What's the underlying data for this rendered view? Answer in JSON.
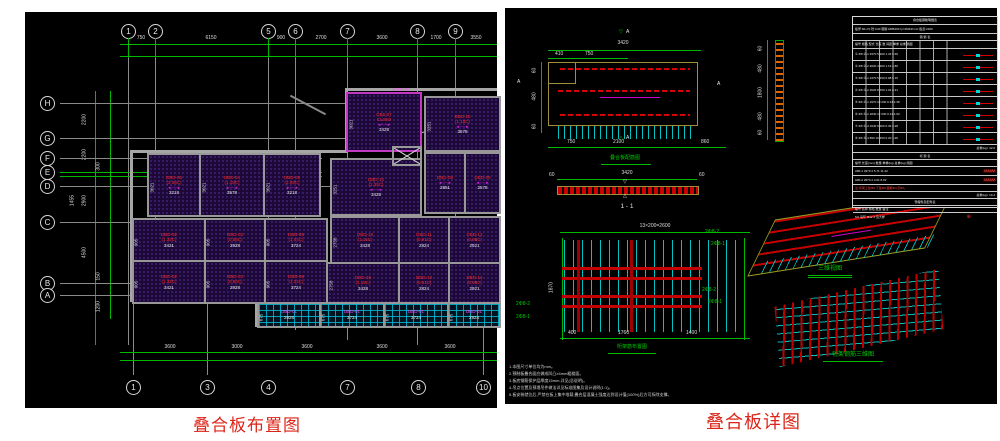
{
  "captions": {
    "left": "叠合板布置图",
    "right": "叠合板详图"
  },
  "glyphs": {
    "arrow": "◄──►",
    "zigzag": "∧∧∧∧∧∧",
    "circle": "⊕",
    "tri_up": "△",
    "tri_down": "▽"
  },
  "left_plan": {
    "top_bubbles": [
      "1",
      "2",
      "5",
      "6",
      "7",
      "8",
      "9"
    ],
    "top_dims": [
      "750",
      "6150",
      "900",
      "2700",
      "3600",
      "1700",
      "3550"
    ],
    "left_bubbles": [
      "H",
      "G",
      "F",
      "E",
      "D",
      "C",
      "B",
      "A"
    ],
    "left_dims": [
      "2200",
      "2200",
      "300",
      "2900",
      "4500",
      "150",
      "1200",
      "1455"
    ],
    "bottom_dims": [
      "3600",
      "3000",
      "3600",
      "3600",
      "3600"
    ],
    "bottom_bubbles": [
      "1",
      "3",
      "4",
      "7",
      "8",
      "10"
    ],
    "tag": "1025130",
    "slabs": [
      {
        "id": "DB6-07",
        "cap": "CL08O",
        "dim": "3428",
        "side": "3021"
      },
      {
        "id": "DBD-15",
        "cap": "(1.18C)",
        "dim": "3578",
        "side": "3251"
      },
      {
        "id": "DBD-06",
        "cap": "(2.08C)",
        "dim": "3218",
        "side": "3021"
      },
      {
        "id": "DBD-04",
        "cap": "(1.18C)",
        "dim": "3578",
        "side": "3021"
      },
      {
        "id": "DBD-06",
        "cap": "(2.08C)",
        "dim": "3218",
        "side": "3021"
      },
      {
        "id": "DBD-10",
        "cap": "(1.35C)",
        "dim": "3428",
        "side": "3251"
      },
      {
        "id": "DBD-08",
        "cap": "(0.95C)",
        "dim": "2851",
        "side": "3051"
      },
      {
        "id": "DBD-09",
        "cap": "(0.91C)",
        "dim": "2578",
        "side": "3051"
      },
      {
        "id": "DBD-18",
        "cap": "(1.15C)",
        "dim": "3428",
        "side": "2758"
      },
      {
        "id": "DBD-02",
        "cap": "(1.32C)",
        "dim": "3421",
        "side": "905"
      },
      {
        "id": "DBD-03",
        "cap": "(0.88C)",
        "dim": "2928",
        "side": "905"
      },
      {
        "id": "DBD-05",
        "cap": "(1.04C)",
        "dim": "3724",
        "side": "905"
      },
      {
        "id": "DBD-11",
        "cap": "(0.91C)",
        "dim": "2824",
        "side": "2851"
      },
      {
        "id": "DBD-12",
        "cap": "(0.95C)",
        "dim": "2921",
        "side": "2851"
      },
      {
        "id": "DBD-02",
        "cap": "(1.32C)",
        "dim": "3421",
        "side": "905"
      },
      {
        "id": "DBD-03",
        "cap": "(0.88C)",
        "dim": "2928",
        "side": "905"
      },
      {
        "id": "DBD-05",
        "cap": "(1.04C)",
        "dim": "3724",
        "side": "905"
      },
      {
        "id": "DBD-16",
        "cap": "(1.15C)",
        "dim": "3428",
        "side": "2758"
      },
      {
        "id": "DBD-13",
        "cap": "(0.91C)",
        "dim": "2824",
        "side": "2851"
      },
      {
        "id": "DBD-14",
        "cap": "(0.95C)",
        "dim": "2921",
        "side": "2851"
      },
      {
        "id": "DBD-01",
        "cap": "(1.08C)",
        "dim": "2928",
        "side": "675"
      },
      {
        "id": "DBD-01",
        "cap": "(1.08C)",
        "dim": "3724",
        "side": "675"
      },
      {
        "id": "DBD-01",
        "cap": "(1.08C)",
        "dim": "3724",
        "side": "675"
      },
      {
        "id": "DBD-01",
        "cap": "(1.08C)",
        "dim": "2924",
        "side": "675"
      }
    ]
  },
  "right_detail": {
    "plan": {
      "top_dim": "3420",
      "sub_dims": [
        "410",
        "750"
      ],
      "bottom_dims": [
        "750",
        "2100",
        "860"
      ],
      "left_dims": [
        "60",
        "480",
        "60"
      ],
      "mark": "A",
      "caption": "叠合板配筋图"
    },
    "strip_dims": [
      "60",
      "480",
      "1800",
      "480",
      "60"
    ],
    "sec": {
      "dim": "3420",
      "end_left": "60",
      "end_right": "60",
      "label": "1 - 1"
    },
    "truss": {
      "top_dim": "13×200=2600",
      "bottom_dims": [
        "400",
        "1760",
        "1400"
      ],
      "side_dim": "1870",
      "caption": "桁架筋布置图",
      "leaders": [
        "2Φ8-2",
        "2Φ8-1",
        "2Φ8-2",
        "2Φ8-1",
        "2Φ8-2",
        "2Φ8-1"
      ]
    },
    "iso1_caption": "三维视图",
    "iso2_caption": "桁架钢筋三维图",
    "notes": [
      "1.本图尺寸单位均为mm。",
      "2.预制板叠合面应做成凹凸≥4mm粗糙面。",
      "3.板底钢筋保护层厚度15mm,详见(总说明)。",
      "4.吊点位置及预埋吊件做法详见标准图集及设计说明(1:1)。",
      "5.板安装就位后,严禁在板上集中堆载,叠合层混凝土强度达到设计值(100%)后方可拆除支撑。"
    ],
    "table": {
      "title": "叠合板钢筋明细表",
      "info": "板厚:60+70  砼:C30  钢筋:HRB400 fy=360N/mm²  板宽:2400",
      "band1": "钢  筋  表",
      "header1": "编号 规格 型式 长度 数 间距 单重 总重 简图",
      "rows1": [
        "① Φ8 ②-1 3370 5 200 1.33 6.65",
        "② Φ8 ②-2 3020 4 200 1.19 4.80",
        "③ Φ8 ③-1 2470 5 150 0.98 5.15",
        "④ Φ8 ③-2 2620 8 150 1.04 8.31",
        "⑤ Φ6 ④-1 1970 10 200 0.44 4.38",
        "⑥ Φ6 ④-2 1840 12 200 0.41 4.90",
        "⑦ Φ6 ④-3 1640 9 200 0.36 3.28",
        "⑧ Φ6 ⑤-4 890 10 250 0.20 1.96"
      ],
      "total1": "总重(kg):  42.6",
      "band2": "桁  架  表",
      "header2": "编号  长度(mm)  数量  单重(kg)  总重(kg)  简图",
      "rows2": [
        "A80-1   3370   2   5.71   11.42",
        "A80-2   2670   2   4.01   8.02"
      ],
      "note": "注:桁架上弦Φ8,下弦Φ8,腹筋Φ4,高80。",
      "total2": "总重(kg):  19.4",
      "band3": "预埋件及配件表",
      "header3": "编号   名称   规格   数量   备注",
      "row3": "M1   吊环   Φ12      4   见大样"
    }
  }
}
